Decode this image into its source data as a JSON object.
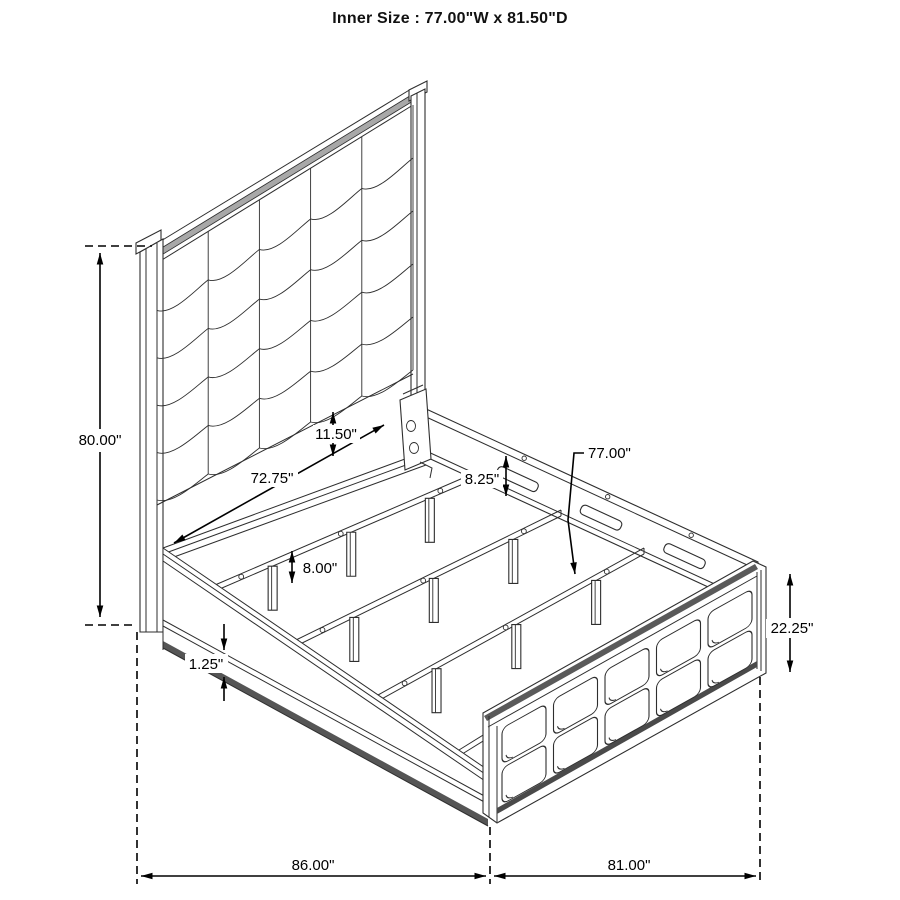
{
  "title": "Inner Size : 77.00\"W x 81.50\"D",
  "dimensions": {
    "headboard_height": "80.00\"",
    "rail_length": "72.75\"",
    "headboard_to_rail": "11.50\"",
    "side_rail_height": "8.25\"",
    "inner_width": "77.00\"",
    "slat_leg_height": "8.00\"",
    "base_trim": "1.25\"",
    "footboard_height": "22.25\"",
    "overall_length": "86.00\"",
    "overall_width": "81.00\""
  },
  "colors": {
    "line": "#2e2e2e",
    "dimension": "#000000",
    "background": "#ffffff",
    "headboard_trim": "#a8a8a8",
    "footboard_cap": "#5a5a5a"
  }
}
